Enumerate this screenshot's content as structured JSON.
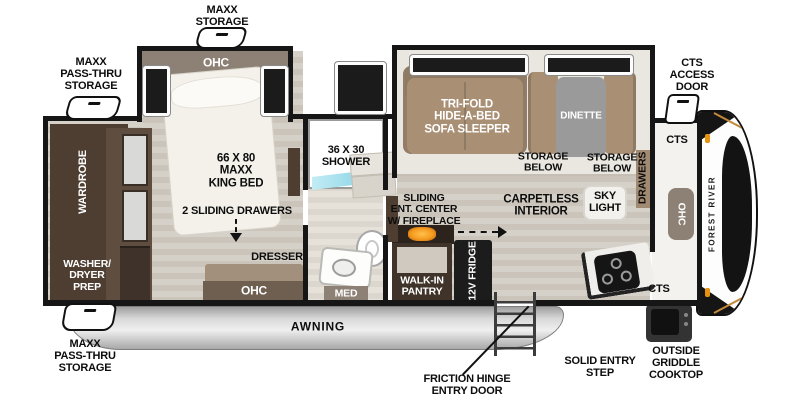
{
  "plan": {
    "title": "Fifth wheel travel trailer floor plan",
    "brand_vertical": "FOREST RIVER",
    "exterior": {
      "maxx_storage": "MAXX\nSTORAGE",
      "maxx_passthru_top": "MAXX\nPASS-THRU\nSTORAGE",
      "maxx_passthru_bottom": "MAXX\nPASS-THRU\nSTORAGE",
      "cts_access_door": "CTS\nACCESS\nDOOR",
      "awning": "AWNING",
      "friction_hinge_entry_door": "FRICTION HINGE\nENTRY DOOR",
      "solid_entry_step": "SOLID ENTRY\nSTEP",
      "outside_griddle_cooktop": "OUTSIDE\nGRIDDLE\nCOOKTOP"
    },
    "bedroom": {
      "ohc": "OHC",
      "bed": "66 X 80\nMAXX\nKING BED",
      "sliding_drawers": "2 SLIDING DRAWERS",
      "dresser": "DRESSER",
      "dresser_ohc": "OHC",
      "wardrobe": "WARDROBE",
      "washer_dryer_prep": "WASHER/\nDRYER\nPREP"
    },
    "bathroom": {
      "shower": "36 X 30\nSHOWER",
      "med": "MED"
    },
    "living": {
      "sofa": "TRI-FOLD\nHIDE-A-BED\nSOFA SLEEPER",
      "dinette": "DINETTE",
      "storage_below_left": "STORAGE\nBELOW",
      "storage_below_right": "STORAGE\nBELOW",
      "drawers": "DRAWERS",
      "carpetless_interior": "CARPETLESS\nINTERIOR",
      "sky_light": "SKY\nLIGHT"
    },
    "kitchen": {
      "ent_center": "SLIDING\nENT. CENTER\nW/ FIREPLACE",
      "walk_in_pantry": "WALK-IN\nPANTRY",
      "fridge": "12V\nFRIDGE",
      "cts_upper": "CTS",
      "cts_lower": "CTS",
      "ohc_side": "OHC"
    },
    "colors": {
      "wall": "#161616",
      "floor_light": "#d6d1c8",
      "floor_dark": "#cac4ba",
      "cabinet_dark_brown": "#4e3e32",
      "cabinet_taupe": "#8d8175",
      "sofa_tan": "#a98f74",
      "table_gray": "#9a9a9a",
      "shower_teal": "#8fd9e8",
      "fireplace_orange": "#f59a1e",
      "awning_silver": "#c9c9c9",
      "marker_amber": "#e8930f"
    }
  }
}
